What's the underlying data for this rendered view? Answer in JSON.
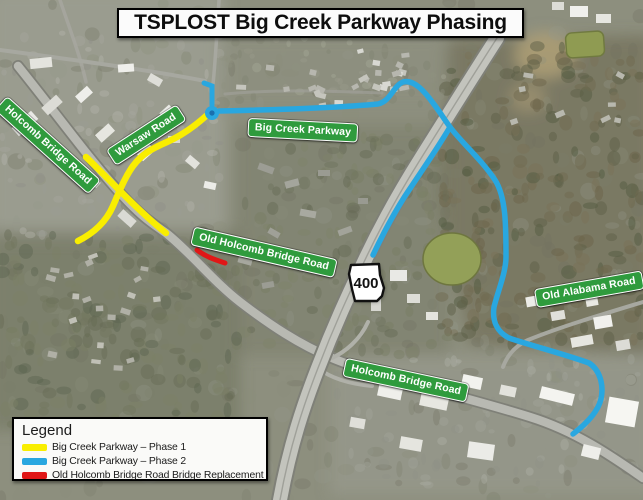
{
  "title": "TSPLOST Big Creek Parkway Phasing",
  "map": {
    "road_signs": [
      {
        "id": "holcomb-bridge-road-upper",
        "label": "Holcomb Bridge Road"
      },
      {
        "id": "warsaw-road",
        "label": "Warsaw Road"
      },
      {
        "id": "big-creek-parkway",
        "label": "Big Creek Parkway"
      },
      {
        "id": "old-holcomb-bridge-road",
        "label": "Old Holcomb Bridge Road"
      },
      {
        "id": "old-alabama-road",
        "label": "Old Alabama Road"
      },
      {
        "id": "holcomb-bridge-road-lower",
        "label": "Holcomb Bridge Road"
      }
    ],
    "route_shield": {
      "type": "georgia-state-route-shield",
      "number": "400"
    }
  },
  "legend": {
    "heading": "Legend",
    "items": [
      {
        "name": "phase-1",
        "label": "Big Creek Parkway – Phase 1",
        "color": "#f9ee00"
      },
      {
        "name": "phase-2",
        "label": "Big Creek Parkway – Phase 2",
        "color": "#29a7e0"
      },
      {
        "name": "bridge-replacement",
        "label": "Old Holcomb Bridge Road Bridge Replacement",
        "color": "#e01717"
      }
    ]
  },
  "colors": {
    "sign_green": "#2f9b3d",
    "sign_text": "#ffffff",
    "title_background": "#fbfbfb",
    "title_border": "#000000",
    "roundabout_center": "#1a6fae"
  }
}
